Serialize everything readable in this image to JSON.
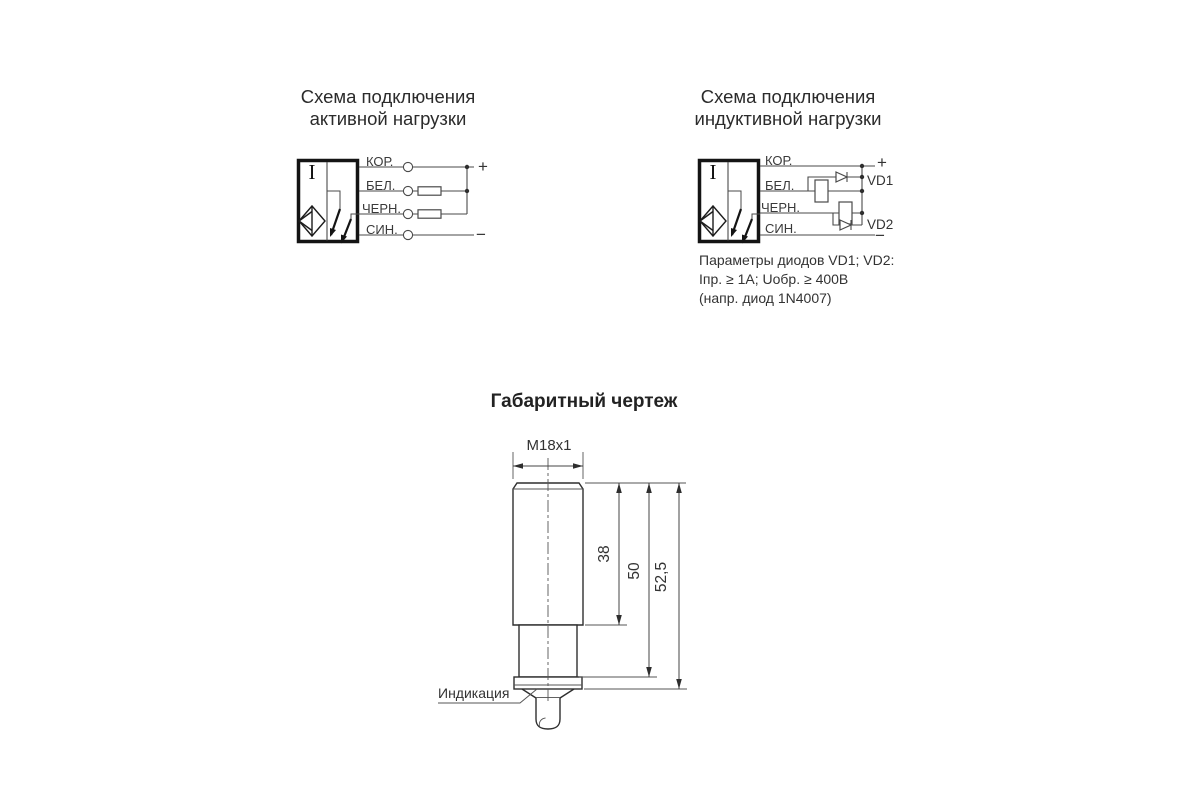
{
  "active_load_schematic": {
    "title_line1": "Схема подключения",
    "title_line2": "активной нагрузки",
    "sensor_marking": "I",
    "wire_labels": [
      "КОР.",
      "БЕЛ.",
      "ЧЕРН.",
      "СИН."
    ],
    "plus_label": "+",
    "minus_label": "−"
  },
  "inductive_load_schematic": {
    "title_line1": "Схема подключения",
    "title_line2": "индуктивной нагрузки",
    "sensor_marking": "I",
    "wire_labels": [
      "КОР.",
      "БЕЛ.",
      "ЧЕРН.",
      "СИН."
    ],
    "plus_label": "+",
    "minus_label": "−",
    "diode_labels": [
      "VD1",
      "VD2"
    ],
    "note_lines": [
      "Параметры диодов VD1; VD2:",
      "Iпр. ≥ 1А; Uобр. ≥ 400В",
      "(напр. диод 1N4007)"
    ]
  },
  "dimension_drawing": {
    "title": "Габаритный чертеж",
    "thread_label": "M18x1",
    "dim_thread_length": "38",
    "dim_body_length": "50",
    "dim_total_length": "52,5",
    "indication_label": "Индикация"
  }
}
